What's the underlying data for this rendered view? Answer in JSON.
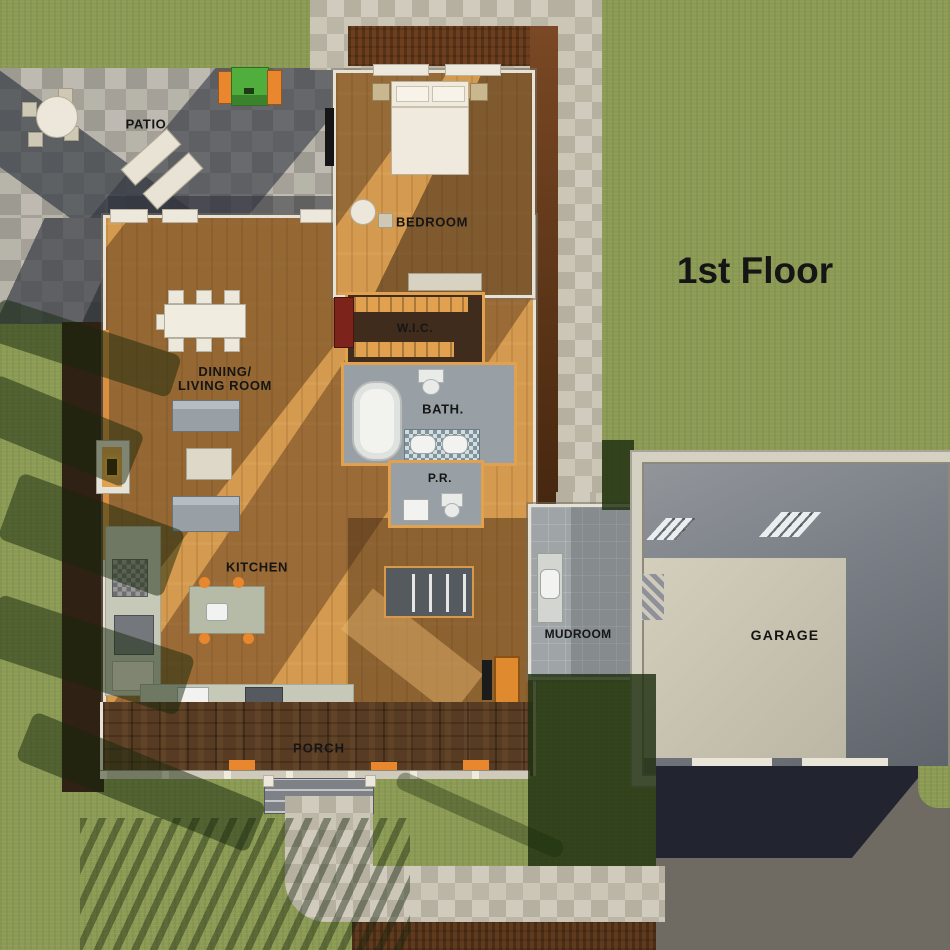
{
  "title": "1st Floor",
  "labels": {
    "patio": "PATIO",
    "bedroom": "BEDROOM",
    "wic": "W.I.C.",
    "dining_line1": "DINING/",
    "dining_line2": "LIVING ROOM",
    "bath": "BATH.",
    "powder_room": "P.R.",
    "kitchen": "KITCHEN",
    "mudroom": "MUDROOM",
    "garage": "GARAGE",
    "porch": "PORCH"
  },
  "colors": {
    "grass": "#8c9b54",
    "stone": "#b3afa5",
    "stone_light": "#c7c1b0",
    "wood": "#d49a4f",
    "wood_dark": "#6b4527",
    "wall_cream": "#e6e2d5",
    "wall_orange": "#e2a14f",
    "mulch": "#6d3f1e",
    "mulch_dark": "#2f2114",
    "porch_wood": "#573b22",
    "tile_gray": "#9fa4a6",
    "bath_gray": "#98a0a5",
    "wic_brown": "#3f2c1c",
    "garage_floor": "#70757c",
    "garage_pad": "#cbc5b3",
    "driveway": "#6f6b62",
    "shadow_navy": "#1b1f2b",
    "grill_green": "#4fae3c",
    "grill_orange": "#e8872e",
    "dresser_red": "#7c231b",
    "sofa": "#98a0a6",
    "island": "#b6bba8",
    "counter": "#c7c9b8",
    "stairs": "#555a5e",
    "label_ink": "#151515",
    "bed_white": "#efeadd"
  }
}
